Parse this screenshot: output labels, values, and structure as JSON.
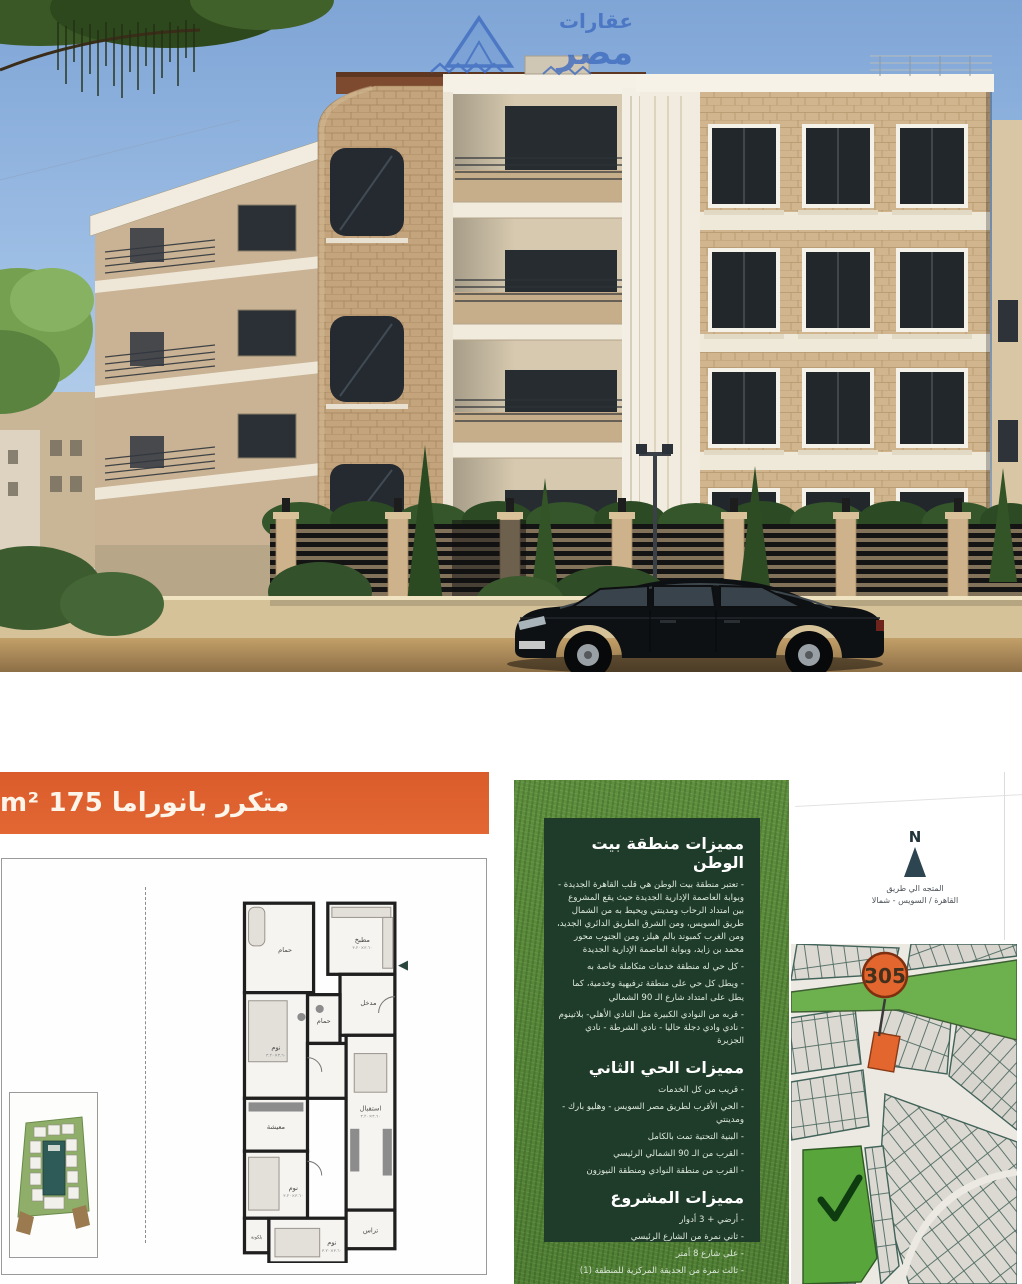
{
  "photo": {
    "watermark": {
      "line1": "عقارات",
      "line2": "مصر"
    }
  },
  "unit_banner": {
    "label": "متكرر بانوراما 175 m²"
  },
  "floor_plan": {
    "rooms": {
      "kitchen": "مطبخ",
      "entrance": "مدخل",
      "bath": "حمام",
      "bedroom": "نوم",
      "living": "معيشة",
      "reception": "استقبال",
      "terrace": "تراس",
      "balcony": "بلكونة"
    },
    "dims": "٣.٦٠×٣.٢٠"
  },
  "features_panel": {
    "area": {
      "title": "مميزات منطقة بيت الوطن",
      "items": [
        "تعتبر منطقة بيت الوطن هي قلب القاهرة الجديدة - وبوابة العاصمة الإدارية الجديدة حيث يقع المشروع بين امتداد الرحاب ومدينتي ويحيط به من الشمال طريق السويس، ومن الشرق الطريق الدائري الجديد، ومن الغرب كمبوند بالم هيلز، ومن الجنوب محور محمد بن زايد، وبوابة العاصمة الإدارية الجديدة",
        "كل حي له منطقة خدمات متكاملة خاصة به",
        "ويطل كل حي على منطقة ترفيهية وخدمية، كما يطل على امتداد شارع الـ 90 الشمالي",
        "قربه من النوادي الكبيرة مثل النادي الأهلي- بلاتينوم - نادي وادي دجلة حاليا - نادي الشرطة - نادي الجزيرة"
      ]
    },
    "district": {
      "title": "مميزات الحي الثاني",
      "items": [
        "قريب من كل الخدمات",
        "الحي الأقرب لطريق مصر السويس - وهليو بارك - ومدينتي",
        "البنية التحتية تمت بالكامل",
        "القرب من الـ 90 الشمالي الرئيسي",
        "القرب من منطقة النوادي ومنطقة النيوزون"
      ]
    },
    "project": {
      "title": "مميزات المشروع",
      "items": [
        "أرضي + 3 أدوار",
        "ثاني نمرة من الشارع الرئيسي",
        "على شارع 8 أمتر",
        "ثالث نمرة من الحديقة المركزية للمنطقة (1)"
      ]
    }
  },
  "compass": {
    "letter": "N",
    "caption_line1": "المتجه الي طريق",
    "caption_line2": "القاهرة / السويس - شمالا"
  },
  "map": {
    "plot_number": "305"
  },
  "colors": {
    "accent_orange": "#DD5F2C",
    "panel_dark_green": "#1F3B2A",
    "grass_green": "#5D8F3D",
    "park_green": "#6CB14E",
    "plot_orange": "#E2662E",
    "watermark_blue": "#3E6CC0"
  }
}
